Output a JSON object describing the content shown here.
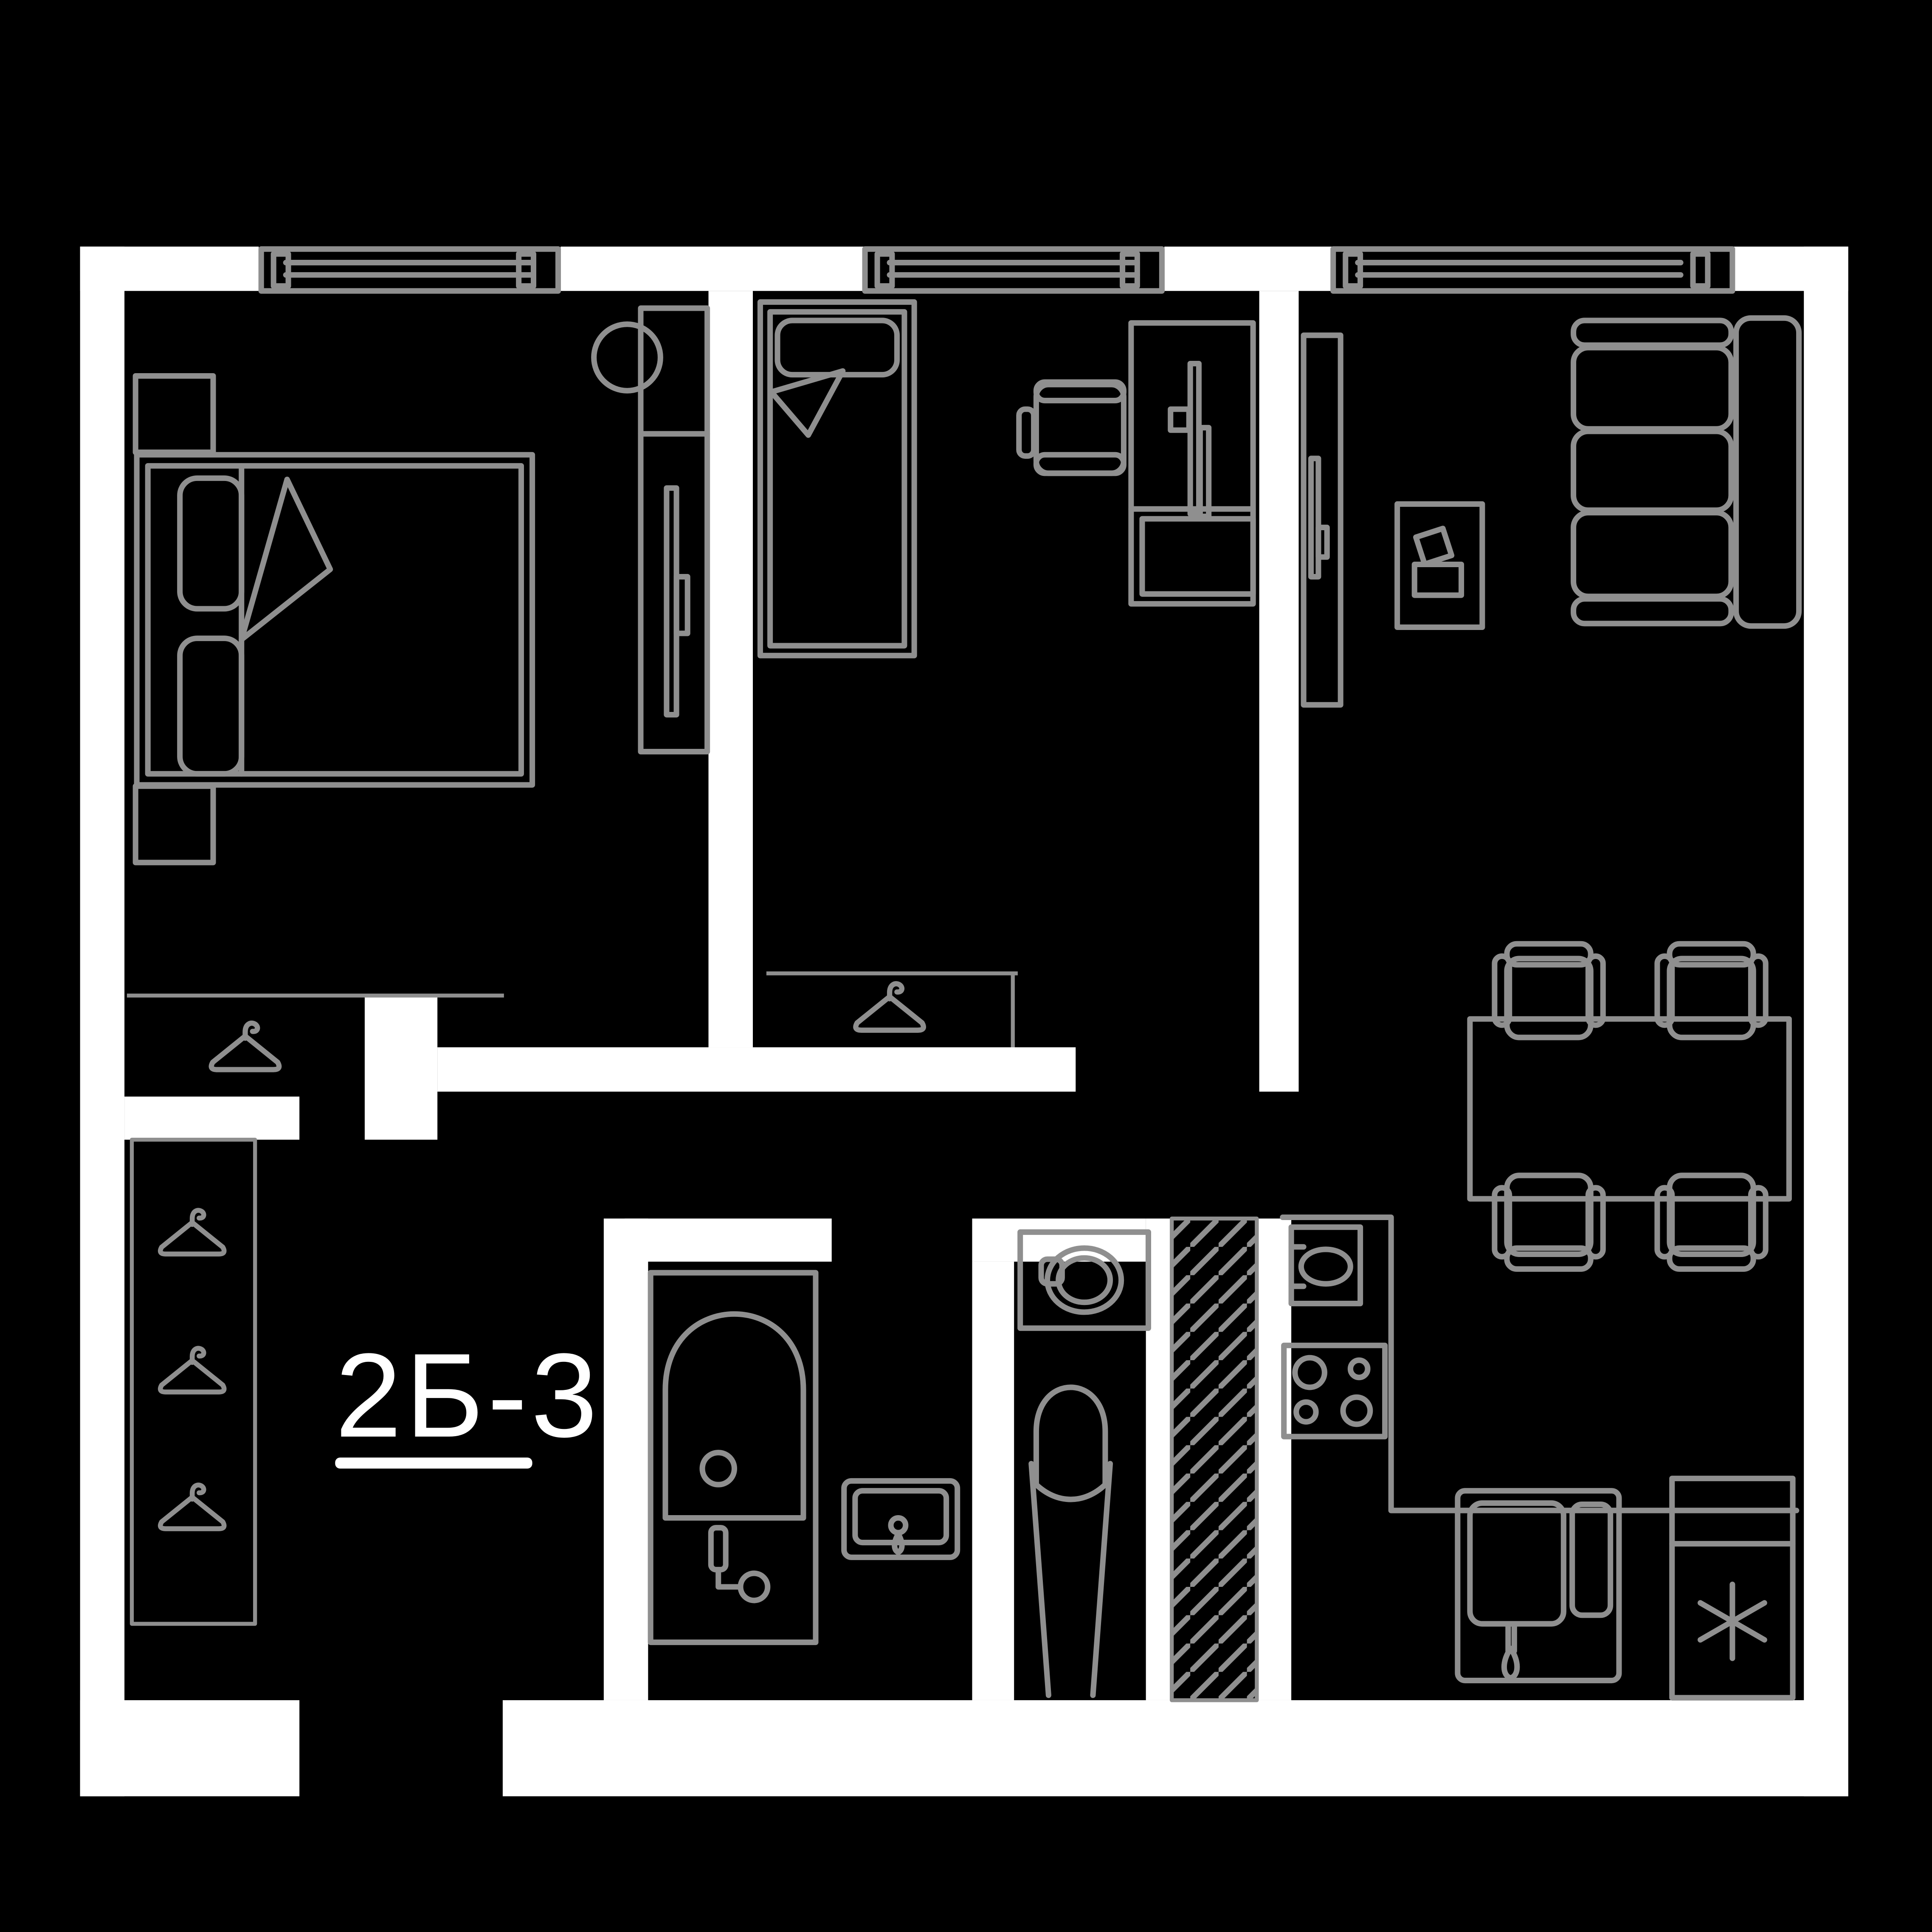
{
  "plan": {
    "unit_label": "2Б-3",
    "colors": {
      "background": "#000000",
      "wall": "#ffffff",
      "furniture_line": "#8f8f8f",
      "label_text": "#ffffff"
    },
    "icons": {
      "hanger": "hanger-icon",
      "window": "window-icon",
      "freezer_asterisk": "snowflake-asterisk-icon",
      "ventilation_shaft": "diagonal-hatch-shaft"
    },
    "furniture_icons": [
      "double-bed",
      "nightstand",
      "wardrobe",
      "stool",
      "single-bed",
      "desk",
      "office-chair",
      "closet-hanger",
      "sofa",
      "coffee-table",
      "tv-cabinet",
      "dining-table",
      "dining-chair",
      "bathtub",
      "bathroom-sink",
      "washing-machine",
      "toilet",
      "ventilation-shaft",
      "kitchen-sink",
      "stove",
      "kitchen-sink-cabinet",
      "fridge",
      "hallway-closet"
    ]
  }
}
